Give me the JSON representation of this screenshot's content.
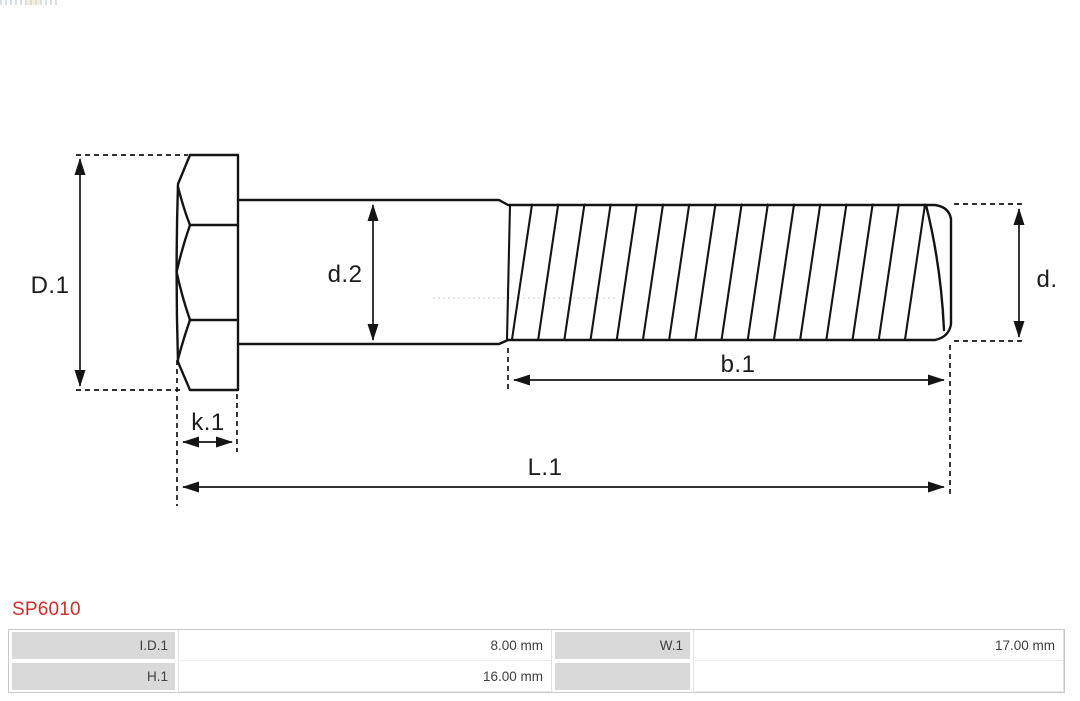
{
  "page": {
    "part_number": "SP6010"
  },
  "diagram": {
    "dim_labels": {
      "D1": "D.1",
      "k1": "k.1",
      "d2": "d.2",
      "b1": "b.1",
      "d": "d.",
      "L1": "L.1"
    }
  },
  "spec_table": {
    "rows": [
      {
        "cells": [
          {
            "t": "I.D.1"
          },
          {
            "t": "8.00 mm"
          },
          {
            "t": "W.1"
          },
          {
            "t": "17.00 mm"
          }
        ]
      },
      {
        "cells": [
          {
            "t": "H.1"
          },
          {
            "t": "16.00 mm"
          },
          {
            "t": ""
          },
          {
            "t": ""
          }
        ]
      }
    ]
  },
  "colors": {
    "part_number_red": "#cf2f2c",
    "drawing_line": "#141414",
    "table_label_bg": "#d9d9d9",
    "table_border": "#c9c9c9",
    "centerline_gray": "#d9d9d9"
  }
}
